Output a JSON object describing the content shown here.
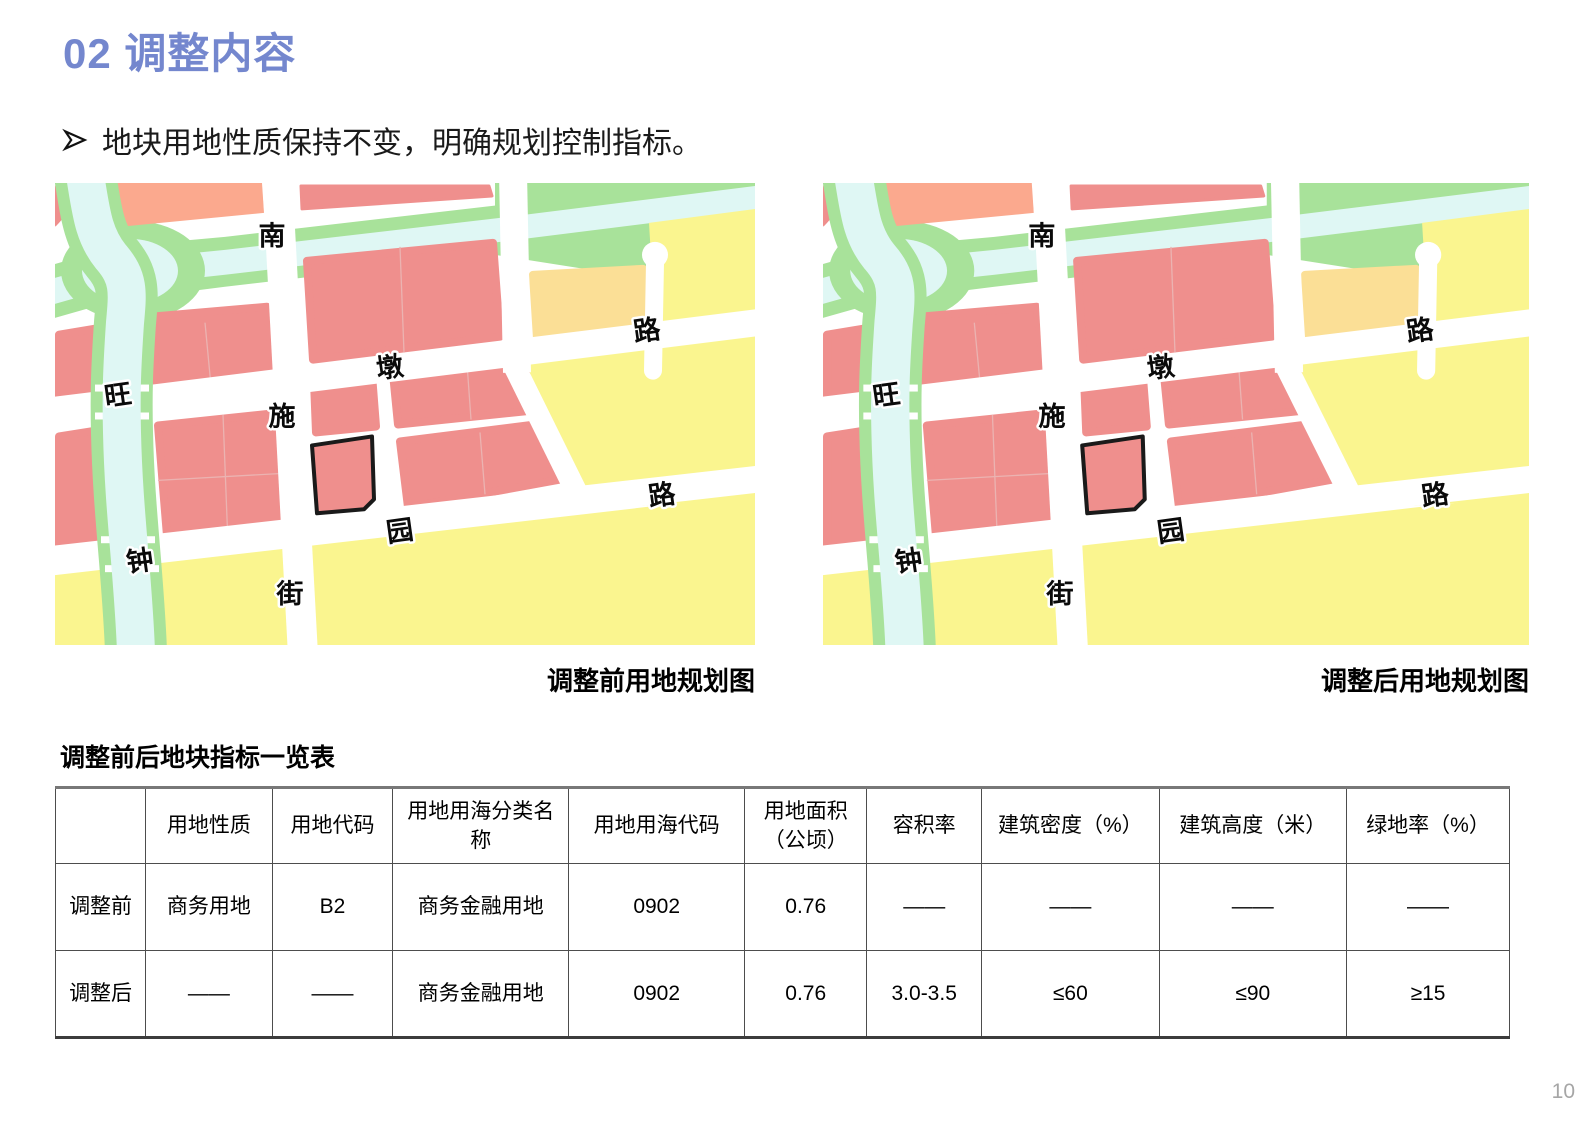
{
  "title": "02 调整内容",
  "bullet": {
    "text": "地块用地性质保持不变，明确规划控制指标。"
  },
  "maps": {
    "before_caption": "调整前用地规划图",
    "after_caption": "调整后用地规划图",
    "road_labels": {
      "nan": "南",
      "shi": "施",
      "jie": "街",
      "wang": "旺",
      "dun": "墩",
      "lu1": "路",
      "zhong": "钟",
      "yuan": "园",
      "lu2": "路"
    },
    "legend_colors": {
      "commercial_pink": "#ef8f8d",
      "residential_salmon": "#fba98e",
      "green_space": "#a8e29a",
      "water": "#dff7f4",
      "orange_mixed": "#fbdf96",
      "yellow_development": "#faf58f",
      "road_white": "#ffffff",
      "focus_parcel_outline": "#1a1a1a"
    }
  },
  "table": {
    "title": "调整前后地块指标一览表",
    "headers": [
      "",
      "用地性质",
      "用地代码",
      "用地用海分类名称",
      "用地用海代码",
      "用地面积（公顷）",
      "容积率",
      "建筑密度（%）",
      "建筑高度（米）",
      "绿地率（%）"
    ],
    "rows": [
      {
        "label": "调整前",
        "cells": [
          "商务用地",
          "B2",
          "商务金融用地",
          "0902",
          "0.76",
          "——",
          "——",
          "——",
          "——"
        ]
      },
      {
        "label": "调整后",
        "cells": [
          "——",
          "——",
          "商务金融用地",
          "0902",
          "0.76",
          "3.0-3.5",
          "≤60",
          "≤90",
          "≥15"
        ]
      }
    ]
  },
  "page": {
    "number": "10"
  },
  "accent_color": "#7487ce"
}
